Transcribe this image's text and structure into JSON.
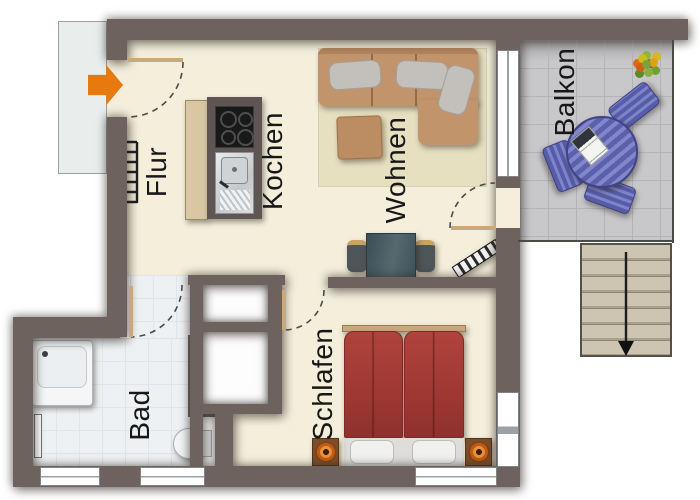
{
  "title": "Apartment floor plan",
  "rooms": {
    "flur": {
      "label": "Flur"
    },
    "kochen": {
      "label": "Kochen"
    },
    "wohnen": {
      "label": "Wohnen"
    },
    "balkon": {
      "label": "Balkon"
    },
    "bad": {
      "label": "Bad"
    },
    "schlafen": {
      "label": "Schlafen"
    }
  },
  "icons": {
    "entrance_arrow": "block-arrow-right",
    "stairs_arrow": "arrow-down",
    "coat_rack": "comb-ticks"
  },
  "colors": {
    "wall": "#6e625e",
    "floor": "#f4eedb",
    "bath_tile": "#eef1f3",
    "balcony_tile": "#c8c8cb",
    "outside": "#ffffff",
    "landing": "#e9edec",
    "accent_arrow": "#e8790f",
    "sofa": "#c2946c",
    "rug": "#e6dfc0",
    "bed": "#a33c36",
    "blue_furniture": "#6468b0",
    "stairs": "#cbc2b0",
    "door_leaf": "#c9a87b",
    "label": "#171717",
    "desk": "#44585f"
  }
}
